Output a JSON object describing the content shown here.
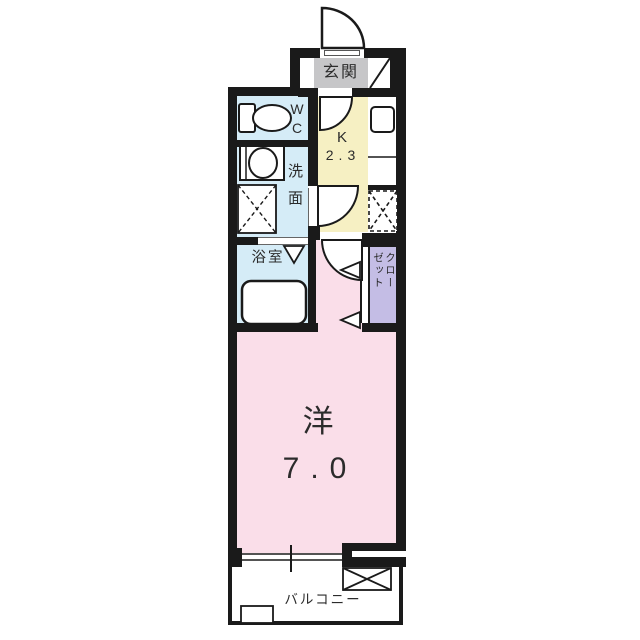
{
  "colors": {
    "wall": "#1a1a1a",
    "water_rooms": "#d5ecf7",
    "kitchen": "#f6f0c3",
    "main_room": "#fadee9",
    "closet": "#c4bde5",
    "entrance_mat": "#c6c6c8"
  },
  "rooms": {
    "entrance": {
      "label": "玄関"
    },
    "wc": {
      "label": "WC"
    },
    "washroom": {
      "label": "洗面"
    },
    "bathroom": {
      "label": "浴室"
    },
    "kitchen": {
      "label": "K",
      "size": "2.3"
    },
    "closet": {
      "label": "クローゼット"
    },
    "western_room": {
      "label": "洋",
      "size": "7.0"
    },
    "balcony": {
      "label": "バルコニー"
    }
  }
}
